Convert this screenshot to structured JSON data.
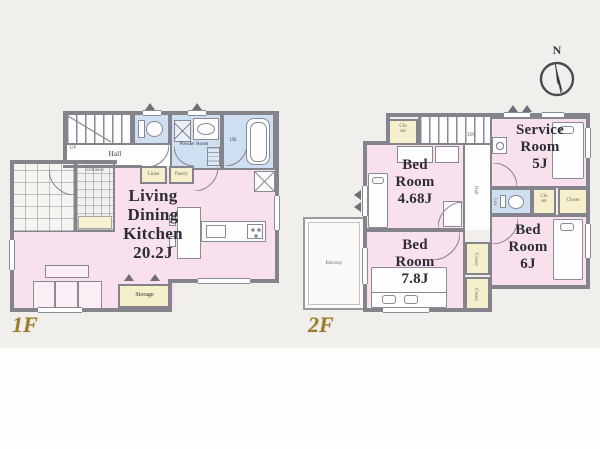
{
  "palette": {
    "wall": "#85848c",
    "room_pink": "#f8e1ec",
    "wet_area_blue": "#cddff0",
    "closet_yellow": "#f5efcb",
    "floor_label_gold": "#9c7d2a",
    "text_ink": "#2d2d38",
    "background": "#f1efec"
  },
  "compass": {
    "north_label": "N"
  },
  "floor1": {
    "label": "1F",
    "rooms": {
      "ldk": "Living\nDining\nKitchen\n20.2J",
      "hall": "Hall",
      "powder_room": "Powder Room",
      "bath": "UB",
      "linen": "Linen",
      "pantry": "Pantry",
      "entrance": "Entrance",
      "storage": "Storage",
      "stairs_direction": "UP"
    }
  },
  "floor2": {
    "label": "2F",
    "rooms": {
      "bedroom_a": "Bed\nRoom\n4.68J",
      "bedroom_b": "Bed\nRoom\n7.8J",
      "bedroom_c": "Bed\nRoom\n6J",
      "service_room": "Service\nRoom\n5J",
      "hall": "Hall",
      "lavatory": "Lav",
      "closet_upper": "Clo\nset",
      "closet_wc": "Clo\nset",
      "closet_wide": "Closet",
      "closet_b1": "Closet",
      "closet_b2": "Closet",
      "balcony": "Balcony",
      "stairs_direction": "DN"
    }
  }
}
